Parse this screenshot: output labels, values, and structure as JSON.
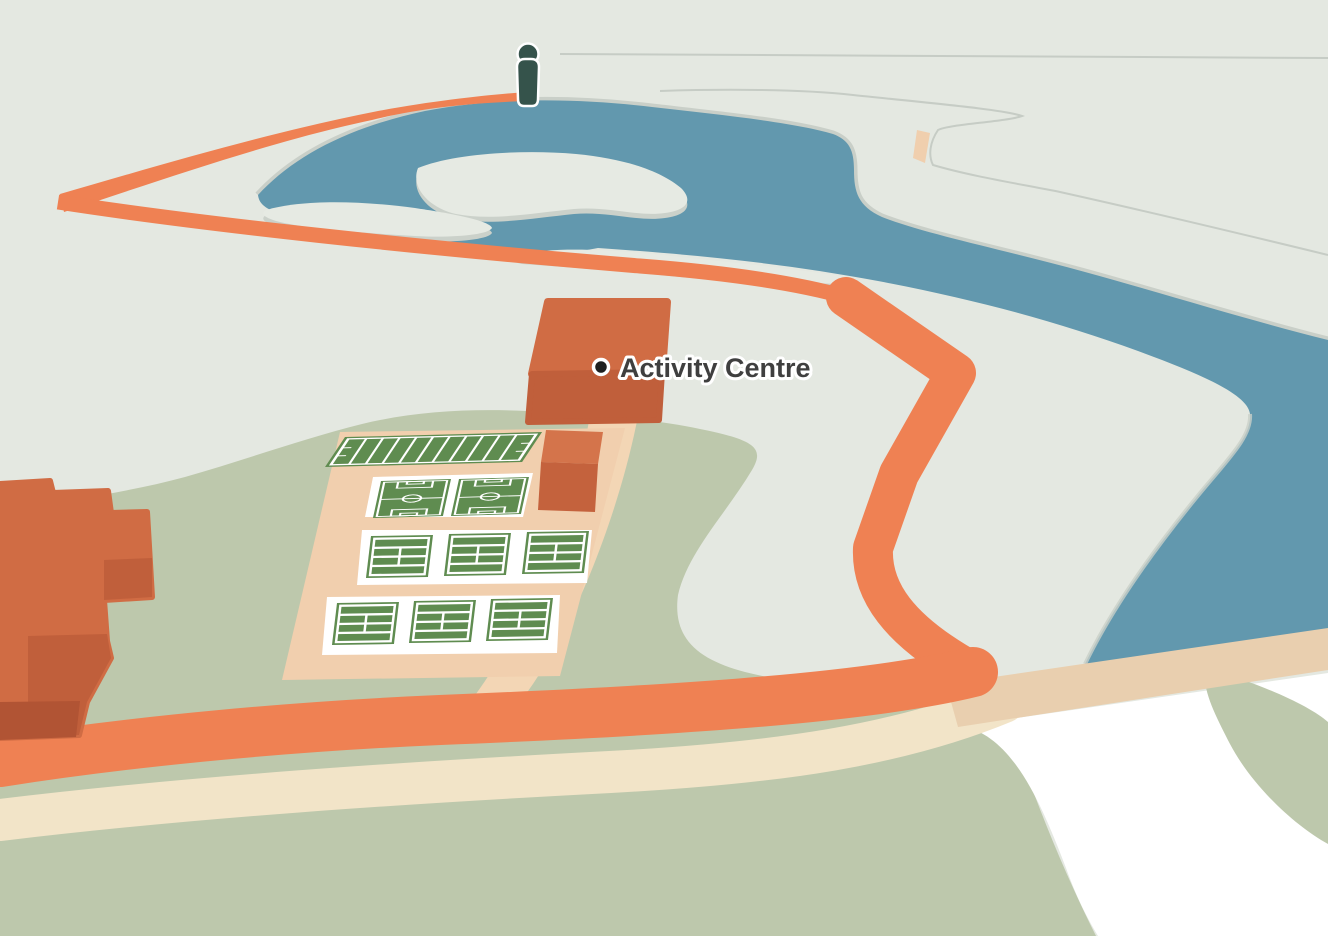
{
  "map": {
    "poi_label": {
      "text": "Activity Centre"
    },
    "person_marker": {
      "icon": "person-icon",
      "present": true
    },
    "features": {
      "water": "lake-and-river",
      "trail": "orange-loop-trail",
      "paths": [
        "cream-footpath",
        "river-crossing-road",
        "vertical-field-path"
      ],
      "sports": {
        "athletics_field_count": 1,
        "football_pitch_count": 2,
        "tennis_court_count": 6,
        "tennis_court_rows": 2
      },
      "buildings": {
        "activity_centre_blocks": 1,
        "small_block_count": 1,
        "west_cluster": "stepped-orange-buildings"
      }
    }
  },
  "palette": {
    "terrain": "#e4e8e1",
    "water": "#6298ae",
    "grass": "#bdc8ac",
    "trail_orange": "#ef8153",
    "path_cream": "#f2e4c8",
    "road_tan": "#e9cfaf",
    "path_light": "#f3d6b5",
    "fields_ground": "#f1cfae",
    "pitch_green": "#5f8c50",
    "court_white": "#ffffff",
    "building_top": "#d06c44",
    "building_side": "#c05f3b",
    "building_shadow": "#b15434",
    "person": "#35534b",
    "poi_dot": "#1f2020",
    "label_text": "#3f3f3f",
    "shore_edge": "#c9cfc8",
    "island": "#e6eae3"
  }
}
